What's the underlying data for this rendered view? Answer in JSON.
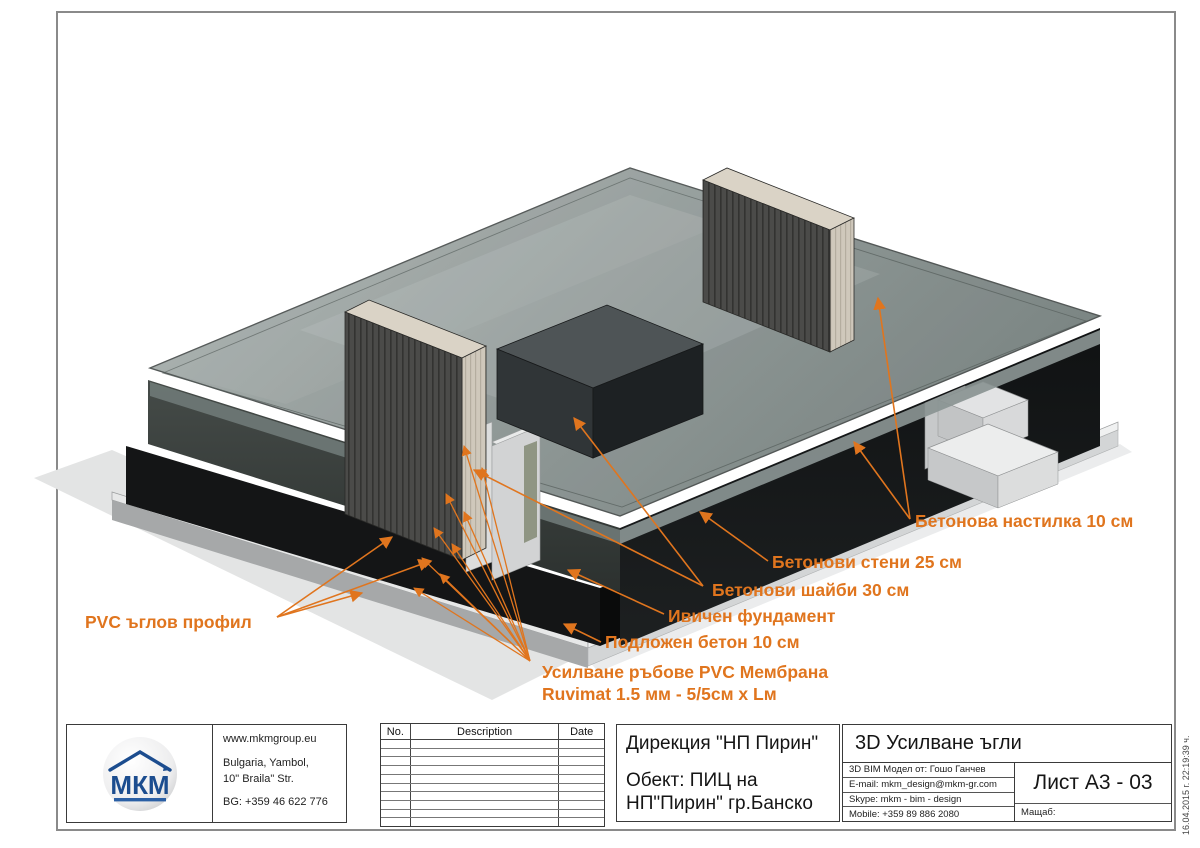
{
  "accent": "#E0751E",
  "annotations": [
    {
      "id": "floor-screed",
      "text": "Бетонова настилка 10 см"
    },
    {
      "id": "walls",
      "text": "Бетонови стени 25 см"
    },
    {
      "id": "shear-walls",
      "text": "Бетонови шайби 30 см"
    },
    {
      "id": "strip-footing",
      "text": "Ивичен фундамент"
    },
    {
      "id": "blinding",
      "text": "Подложен бетон 10 см"
    },
    {
      "id": "edge-reinf-1",
      "text": "Усилване ръбове  PVC Мембрана"
    },
    {
      "id": "edge-reinf-2",
      "text": "Ruvimat 1.5 мм - 5/5см x Lм"
    },
    {
      "id": "pvc-corner",
      "text": "PVC ъглов профил"
    }
  ],
  "title_block": {
    "logo": {
      "text": "МКМ"
    },
    "contact": {
      "website": "www.mkmgroup.eu",
      "address1": "Bulgaria, Yambol,",
      "address2": "10\" Braila\" Str.",
      "phone": "BG: +359 46 622 776"
    },
    "revision_table": {
      "headers": [
        "No.",
        "Description",
        "Date"
      ],
      "empty_rows": 10
    },
    "client": "Дирекция \"НП Пирин\"",
    "object_line1": "Обект: ПИЦ на",
    "object_line2": "НП\"Пирин\" гр.Банско",
    "sheet_title": "3D Усилване ъгли",
    "info_rows": [
      "3D BIM Модел от: Гошо Ганчев",
      "E-mail: mkm_design@mkm-gr.com",
      "Skype: mkm - bim - design",
      "Mobile: +359 89 886 2080"
    ],
    "sheet_no": "Лист А3 - 03",
    "scale_label": "Мащаб:"
  },
  "timestamp": "16.04.2015 г.  22:19:39 ч."
}
